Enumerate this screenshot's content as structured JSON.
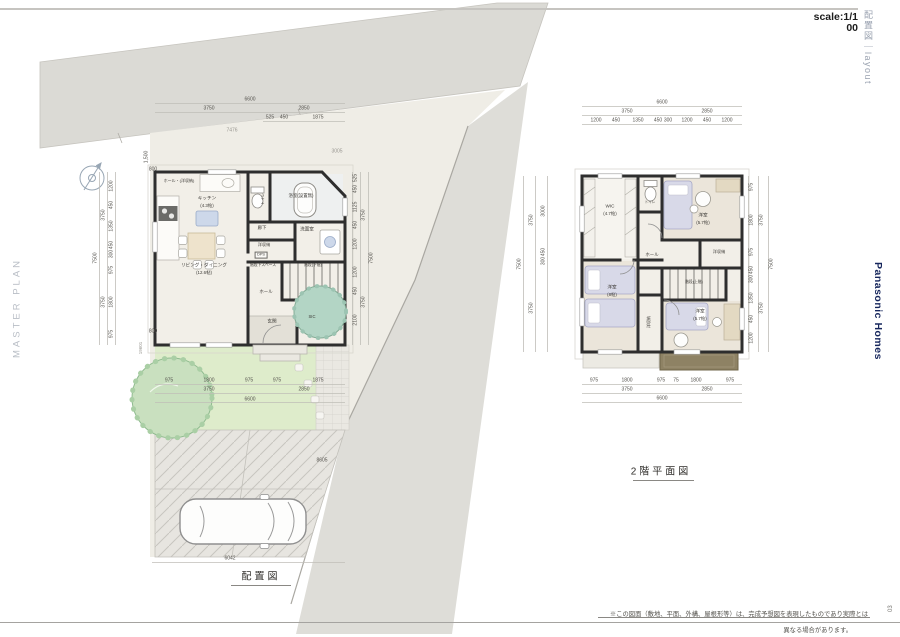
{
  "page": {
    "scale1": "scale:1/1",
    "scale2": "00",
    "corner_vertical": "配置図｜layout",
    "brand": "Panasonic Homes",
    "master_plan": "MASTER PLAN",
    "caption_site": "配置図",
    "caption_2f": "2階平面図",
    "disclaimer1": "※この図面（敷地、平面、外構、屋根形等）は、完成予想図を表現したものであり実際とは",
    "disclaimer2": "異なる場合があります。",
    "page_num": "03"
  },
  "colors": {
    "wall": "#2e2e2e",
    "road": "#dbdad5",
    "site": "#efede6",
    "lawn": "#deeccb",
    "tree": "#c9e0bf",
    "tree2": "#b3d5c5",
    "bed": "#d8d9e8",
    "kitchen_island": "#cdd8ea",
    "balcony": "#8e8264",
    "brand_navy": "#16265c"
  },
  "labels": [
    {
      "t": "6600",
      "x": 250,
      "y": 100
    },
    {
      "t": "3750",
      "x": 209,
      "y": 109
    },
    {
      "t": "2850",
      "x": 304,
      "y": 109
    },
    {
      "t": "525",
      "x": 270,
      "y": 118
    },
    {
      "t": "450",
      "x": 284,
      "y": 118
    },
    {
      "t": "1875",
      "x": 318,
      "y": 118
    },
    {
      "t": "7476",
      "x": 232,
      "y": 131,
      "c": "gray"
    },
    {
      "t": "3005",
      "x": 337,
      "y": 152,
      "c": "gray"
    },
    {
      "t": "800",
      "x": 153,
      "y": 170
    },
    {
      "t": "800",
      "x": 153,
      "y": 332
    },
    {
      "t": "1,500",
      "x": 147,
      "y": 157,
      "r": -90
    },
    {
      "t": "19601",
      "x": 141,
      "y": 348,
      "r": -90,
      "c": "gray",
      "s": 4.5
    },
    {
      "t": "1200",
      "x": 112,
      "y": 186,
      "r": -90
    },
    {
      "t": "450",
      "x": 112,
      "y": 205,
      "r": -90
    },
    {
      "t": "1350",
      "x": 112,
      "y": 226,
      "r": -90
    },
    {
      "t": "450",
      "x": 112,
      "y": 245,
      "r": -90
    },
    {
      "t": "300",
      "x": 112,
      "y": 254,
      "r": -90
    },
    {
      "t": "975",
      "x": 112,
      "y": 270,
      "r": -90
    },
    {
      "t": "1800",
      "x": 112,
      "y": 302,
      "r": -90
    },
    {
      "t": "975",
      "x": 112,
      "y": 334,
      "r": -90
    },
    {
      "t": "3750",
      "x": 104,
      "y": 215,
      "r": -90
    },
    {
      "t": "3750",
      "x": 104,
      "y": 302,
      "r": -90
    },
    {
      "t": "7500",
      "x": 96,
      "y": 258,
      "r": -90
    },
    {
      "t": "525",
      "x": 356,
      "y": 178,
      "r": -90
    },
    {
      "t": "450",
      "x": 356,
      "y": 189,
      "r": -90
    },
    {
      "t": "1125",
      "x": 356,
      "y": 207,
      "r": -90
    },
    {
      "t": "450",
      "x": 356,
      "y": 225,
      "r": -90
    },
    {
      "t": "1200",
      "x": 356,
      "y": 244,
      "r": -90
    },
    {
      "t": "1200",
      "x": 356,
      "y": 272,
      "r": -90
    },
    {
      "t": "450",
      "x": 356,
      "y": 291,
      "r": -90
    },
    {
      "t": "2100",
      "x": 356,
      "y": 320,
      "r": -90
    },
    {
      "t": "3750",
      "x": 364,
      "y": 215,
      "r": -90
    },
    {
      "t": "3750",
      "x": 364,
      "y": 302,
      "r": -90
    },
    {
      "t": "7500",
      "x": 372,
      "y": 258,
      "r": -90
    },
    {
      "t": "975",
      "x": 169,
      "y": 381
    },
    {
      "t": "1800",
      "x": 209,
      "y": 381
    },
    {
      "t": "975",
      "x": 249,
      "y": 381
    },
    {
      "t": "975",
      "x": 277,
      "y": 381
    },
    {
      "t": "1875",
      "x": 318,
      "y": 381
    },
    {
      "t": "3750",
      "x": 209,
      "y": 390
    },
    {
      "t": "2850",
      "x": 304,
      "y": 390
    },
    {
      "t": "6600",
      "x": 250,
      "y": 400
    },
    {
      "t": "6042",
      "x": 230,
      "y": 559
    },
    {
      "t": "8605",
      "x": 322,
      "y": 461
    },
    {
      "t": "ホール・(洋収納)",
      "x": 179,
      "y": 181,
      "s": 4,
      "k": "room"
    },
    {
      "t": "キッチン",
      "x": 207,
      "y": 199,
      "s": 4.6,
      "k": "room"
    },
    {
      "t": "(4.3帖)",
      "x": 207,
      "y": 206,
      "s": 4.4,
      "k": "room"
    },
    {
      "t": "浴室(設置無)",
      "x": 301,
      "y": 196,
      "s": 4.4,
      "k": "room"
    },
    {
      "t": "トイレ",
      "x": 264,
      "y": 199,
      "s": 3.8,
      "r": -90,
      "k": "room"
    },
    {
      "t": "廊下",
      "x": 262,
      "y": 228,
      "s": 4.4,
      "k": "room"
    },
    {
      "t": "洗面室",
      "x": 307,
      "y": 230,
      "s": 4.6,
      "k": "room"
    },
    {
      "t": "洋収納",
      "x": 264,
      "y": 245,
      "s": 4.2,
      "k": "room"
    },
    {
      "t": "DPS",
      "x": 261,
      "y": 255,
      "s": 3.8,
      "k": "room",
      "boxed": 1
    },
    {
      "t": "リビング・ダイニング",
      "x": 204,
      "y": 266,
      "s": 4.6,
      "k": "room"
    },
    {
      "t": "(12.6帖)",
      "x": 204,
      "y": 273,
      "s": 4.4,
      "k": "room"
    },
    {
      "t": "階段下スペース",
      "x": 263,
      "y": 266,
      "s": 3.8,
      "k": "room"
    },
    {
      "t": "階段(下階)",
      "x": 313,
      "y": 266,
      "s": 3.8,
      "k": "room"
    },
    {
      "t": "ホール",
      "x": 266,
      "y": 292,
      "s": 4.4,
      "k": "room"
    },
    {
      "t": "玄関",
      "x": 272,
      "y": 322,
      "s": 4.6,
      "k": "room"
    },
    {
      "t": "SIC",
      "x": 312,
      "y": 317,
      "s": 4.2,
      "k": "room"
    },
    {
      "t": "6600",
      "x": 662,
      "y": 103
    },
    {
      "t": "3750",
      "x": 627,
      "y": 112
    },
    {
      "t": "2850",
      "x": 707,
      "y": 112
    },
    {
      "t": "1200",
      "x": 596,
      "y": 121
    },
    {
      "t": "450",
      "x": 616,
      "y": 121
    },
    {
      "t": "1350",
      "x": 638,
      "y": 121
    },
    {
      "t": "450",
      "x": 658,
      "y": 121
    },
    {
      "t": "300",
      "x": 668,
      "y": 121
    },
    {
      "t": "1200",
      "x": 687,
      "y": 121
    },
    {
      "t": "450",
      "x": 707,
      "y": 121
    },
    {
      "t": "1200",
      "x": 727,
      "y": 121
    },
    {
      "t": "3000",
      "x": 544,
      "y": 211,
      "r": -90
    },
    {
      "t": "450",
      "x": 544,
      "y": 252,
      "r": -90
    },
    {
      "t": "300",
      "x": 544,
      "y": 261,
      "r": -90
    },
    {
      "t": "3750",
      "x": 532,
      "y": 220,
      "r": -90
    },
    {
      "t": "3750",
      "x": 532,
      "y": 308,
      "r": -90
    },
    {
      "t": "7500",
      "x": 520,
      "y": 264,
      "r": -90
    },
    {
      "t": "975",
      "x": 752,
      "y": 187,
      "r": -90
    },
    {
      "t": "1800",
      "x": 752,
      "y": 220,
      "r": -90
    },
    {
      "t": "975",
      "x": 752,
      "y": 252,
      "r": -90
    },
    {
      "t": "450",
      "x": 752,
      "y": 270,
      "r": -90
    },
    {
      "t": "300",
      "x": 752,
      "y": 279,
      "r": -90
    },
    {
      "t": "1350",
      "x": 752,
      "y": 298,
      "r": -90
    },
    {
      "t": "450",
      "x": 752,
      "y": 319,
      "r": -90
    },
    {
      "t": "1200",
      "x": 752,
      "y": 338,
      "r": -90
    },
    {
      "t": "3750",
      "x": 762,
      "y": 220,
      "r": -90
    },
    {
      "t": "3750",
      "x": 762,
      "y": 308,
      "r": -90
    },
    {
      "t": "7500",
      "x": 772,
      "y": 264,
      "r": -90
    },
    {
      "t": "975",
      "x": 594,
      "y": 381
    },
    {
      "t": "1800",
      "x": 627,
      "y": 381
    },
    {
      "t": "975",
      "x": 661,
      "y": 381
    },
    {
      "t": "75",
      "x": 676,
      "y": 381
    },
    {
      "t": "1800",
      "x": 696,
      "y": 381
    },
    {
      "t": "975",
      "x": 730,
      "y": 381
    },
    {
      "t": "3750",
      "x": 627,
      "y": 390
    },
    {
      "t": "2850",
      "x": 707,
      "y": 390
    },
    {
      "t": "6600",
      "x": 662,
      "y": 399
    },
    {
      "t": "WIC",
      "x": 610,
      "y": 207,
      "s": 4.6,
      "k": "room"
    },
    {
      "t": "(4.7帖)",
      "x": 610,
      "y": 214,
      "s": 4.4,
      "k": "room"
    },
    {
      "t": "トイレ",
      "x": 650,
      "y": 203,
      "s": 3.6,
      "k": "room"
    },
    {
      "t": "洋室",
      "x": 703,
      "y": 216,
      "s": 4.6,
      "k": "room"
    },
    {
      "t": "(5.7帖)",
      "x": 703,
      "y": 223,
      "s": 4.4,
      "k": "room"
    },
    {
      "t": "洋収納",
      "x": 719,
      "y": 252,
      "s": 4.2,
      "k": "room"
    },
    {
      "t": "ホール",
      "x": 652,
      "y": 255,
      "s": 4.4,
      "k": "room"
    },
    {
      "t": "階段(上階)",
      "x": 694,
      "y": 283,
      "s": 3.8,
      "k": "room"
    },
    {
      "t": "洋室",
      "x": 612,
      "y": 288,
      "s": 4.6,
      "k": "room"
    },
    {
      "t": "(8帖)",
      "x": 612,
      "y": 295,
      "s": 4.4,
      "k": "room"
    },
    {
      "t": "洋収納",
      "x": 649,
      "y": 322,
      "s": 4,
      "r": -90,
      "k": "room"
    },
    {
      "t": "洋室",
      "x": 700,
      "y": 312,
      "s": 4.6,
      "k": "room"
    },
    {
      "t": "(5.7帖)",
      "x": 700,
      "y": 319,
      "s": 4.4,
      "k": "room"
    }
  ]
}
